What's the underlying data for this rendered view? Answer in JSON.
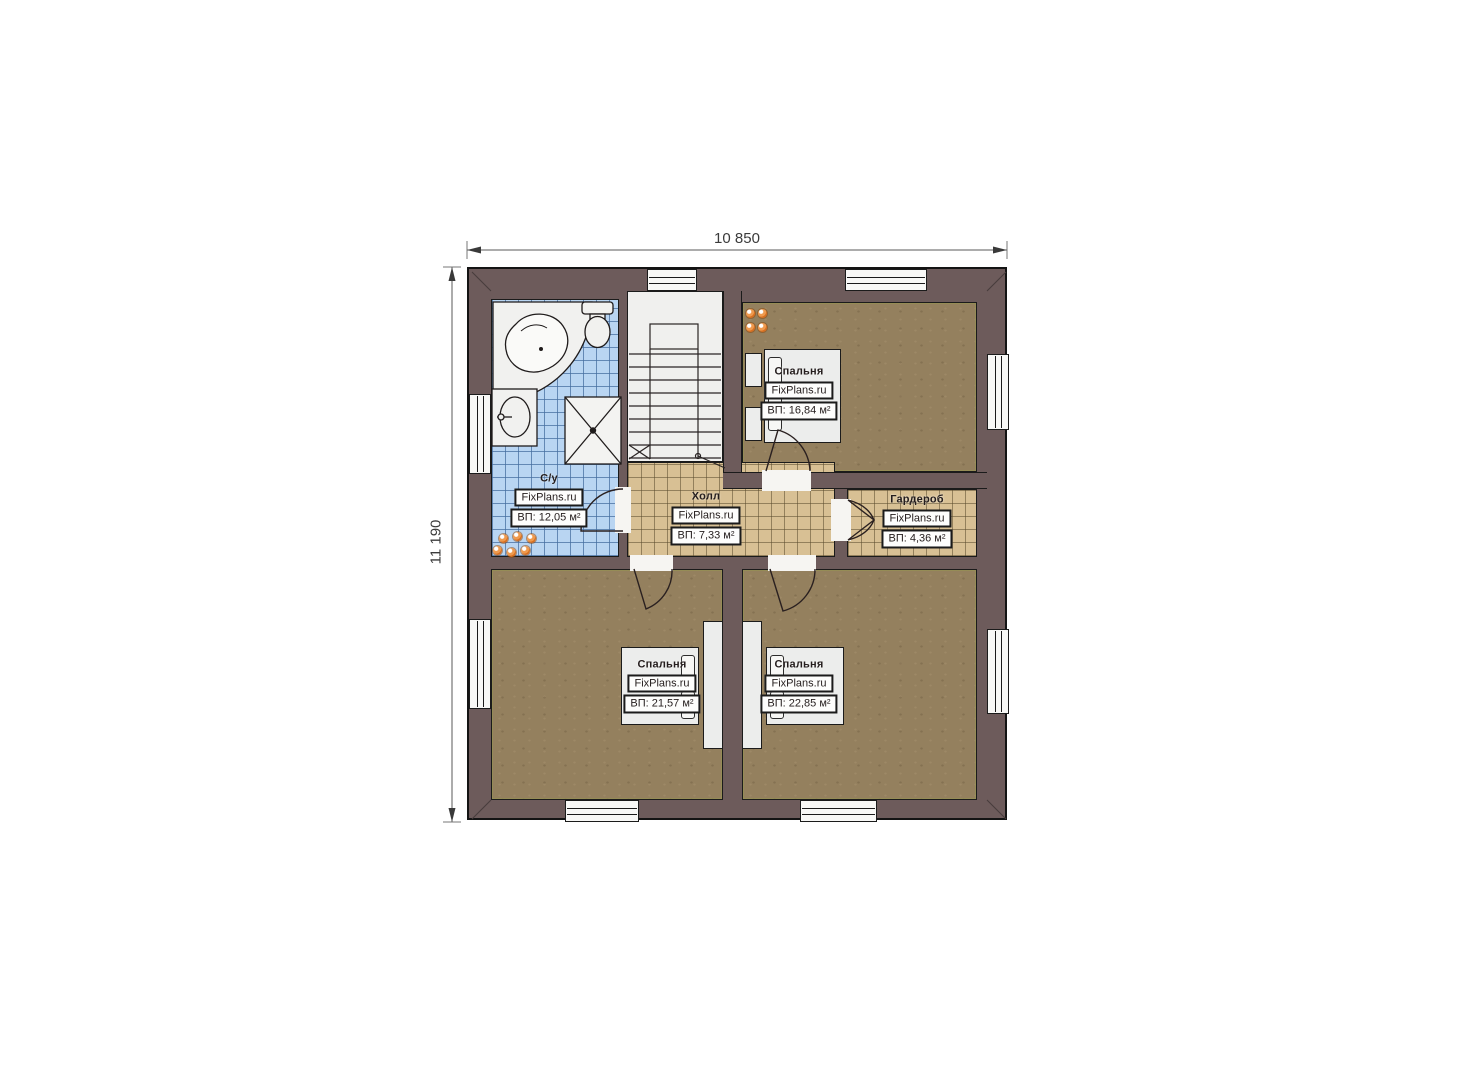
{
  "plan": {
    "top_dimension": "10 850",
    "left_dimension": "11 190"
  },
  "watermark": "FixPlans.ru",
  "rooms": {
    "bathroom": {
      "name": "С/у",
      "area": "ВП: 12,05 м²"
    },
    "hall": {
      "name": "Холл",
      "area": "ВП: 7,33 м²"
    },
    "wardrobe": {
      "name": "Гардероб",
      "area": "ВП: 4,36 м²"
    },
    "bedroom_top_right": {
      "name": "Спальня",
      "area": "ВП: 16,84 м²"
    },
    "bedroom_bottom_left": {
      "name": "Спальня",
      "area": "ВП: 21,57 м²"
    },
    "bedroom_bottom_right": {
      "name": "Спальня",
      "area": "ВП: 22,85 м²"
    }
  },
  "colors": {
    "wall": "#6d5b5b",
    "floor_brown": "#94805e",
    "tile_blue": "#b9d5f2",
    "tile_tan": "#d8c094",
    "stairs": "#f0f0ee",
    "radiator_orange": "#e2803b",
    "outline": "#1b1b1b"
  }
}
